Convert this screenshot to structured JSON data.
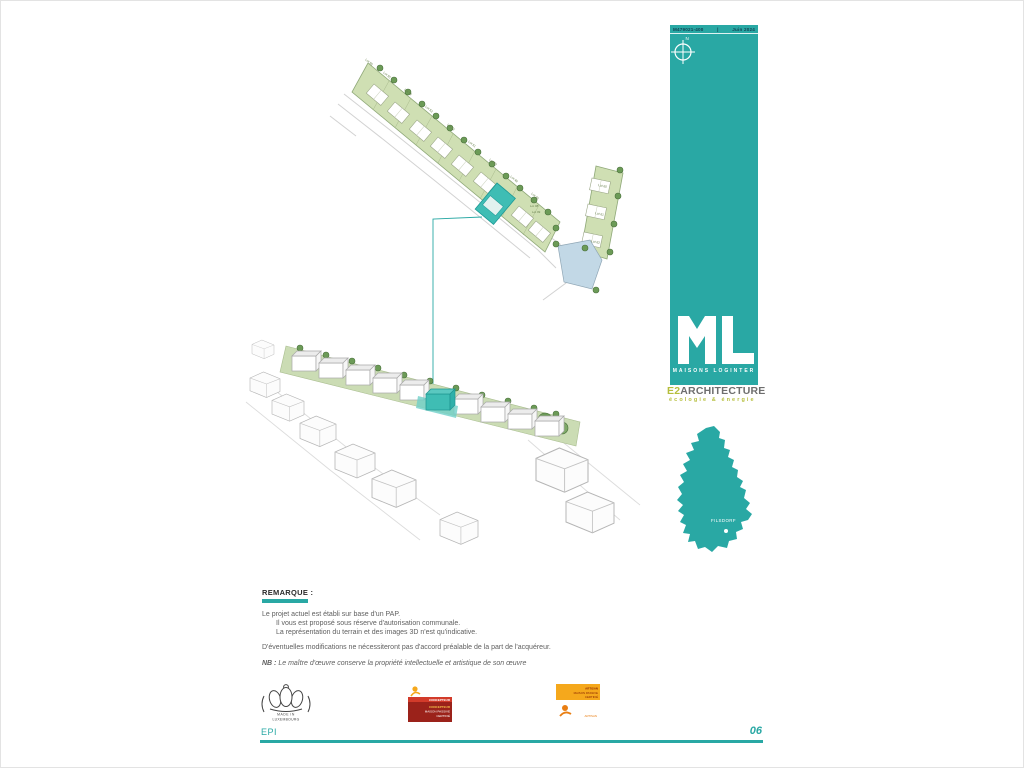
{
  "header": {
    "doc_ref": "M479021-400",
    "separator": "|",
    "date": "Juin 2024"
  },
  "compass": {
    "north_label": "N"
  },
  "brand": {
    "monogram": "ML",
    "company": "MAISONS LOGINTER",
    "studio_prefix": "E2",
    "studio_name": "ARCHITECTURE",
    "studio_tagline": "écologie & énergie"
  },
  "map": {
    "location_label": "FILSDORF"
  },
  "site_plan": {
    "lot_labels": [
      "Lot 56",
      "Lot 55",
      "Lot 54",
      "Lot 53",
      "Lot 52",
      "Lot 51",
      "Lot 50",
      "Lot 49",
      "Lot 48",
      "Lot 08",
      "Lot 09",
      "Lot 60",
      "Lot 61",
      "Lot 62"
    ]
  },
  "remark": {
    "title": "REMARQUE :",
    "lines": [
      "Le projet actuel est établi sur base d'un PAP.",
      "Il vous est proposé sous réserve d'autorisation communale.",
      "La représentation du terrain et des images  3D n'est qu'indicative."
    ],
    "modifications": "D'éventuelles modifications ne nécessiteront pas d'accord préalable de la part de l'acquéreur.",
    "nb_label": "NB :",
    "nb_text": "Le maître d'œuvre conserve la propriété intellectuelle et artistique de son œuvre"
  },
  "badges": {
    "made_in": {
      "line1": "MADE IN",
      "line2": "LUXEMBOURG"
    },
    "concepteur": {
      "band": "CONCEPTEUR",
      "line1": "CONCEPTEUR",
      "line2": "MAISON PASSIVE",
      "line3": "CERTIFIÉ"
    },
    "artisan": {
      "line1": "ARTISAN",
      "line2": "MAISON PASSIVE",
      "line3": "CERTIFIÉ",
      "caption": "ARTISAN"
    }
  },
  "footer": {
    "project_code": "EPI",
    "page_number": "06"
  },
  "colors": {
    "teal": "#29A8A4",
    "highlight_teal": "#3FBDB4",
    "plan_green": "#CFDFB3",
    "tree_green": "#6C9B57",
    "e2_yellow": "#B5BE3C",
    "badge_red": "#9B221A",
    "badge_red_band": "#D23B2A",
    "badge_orange": "#F5A81C"
  }
}
